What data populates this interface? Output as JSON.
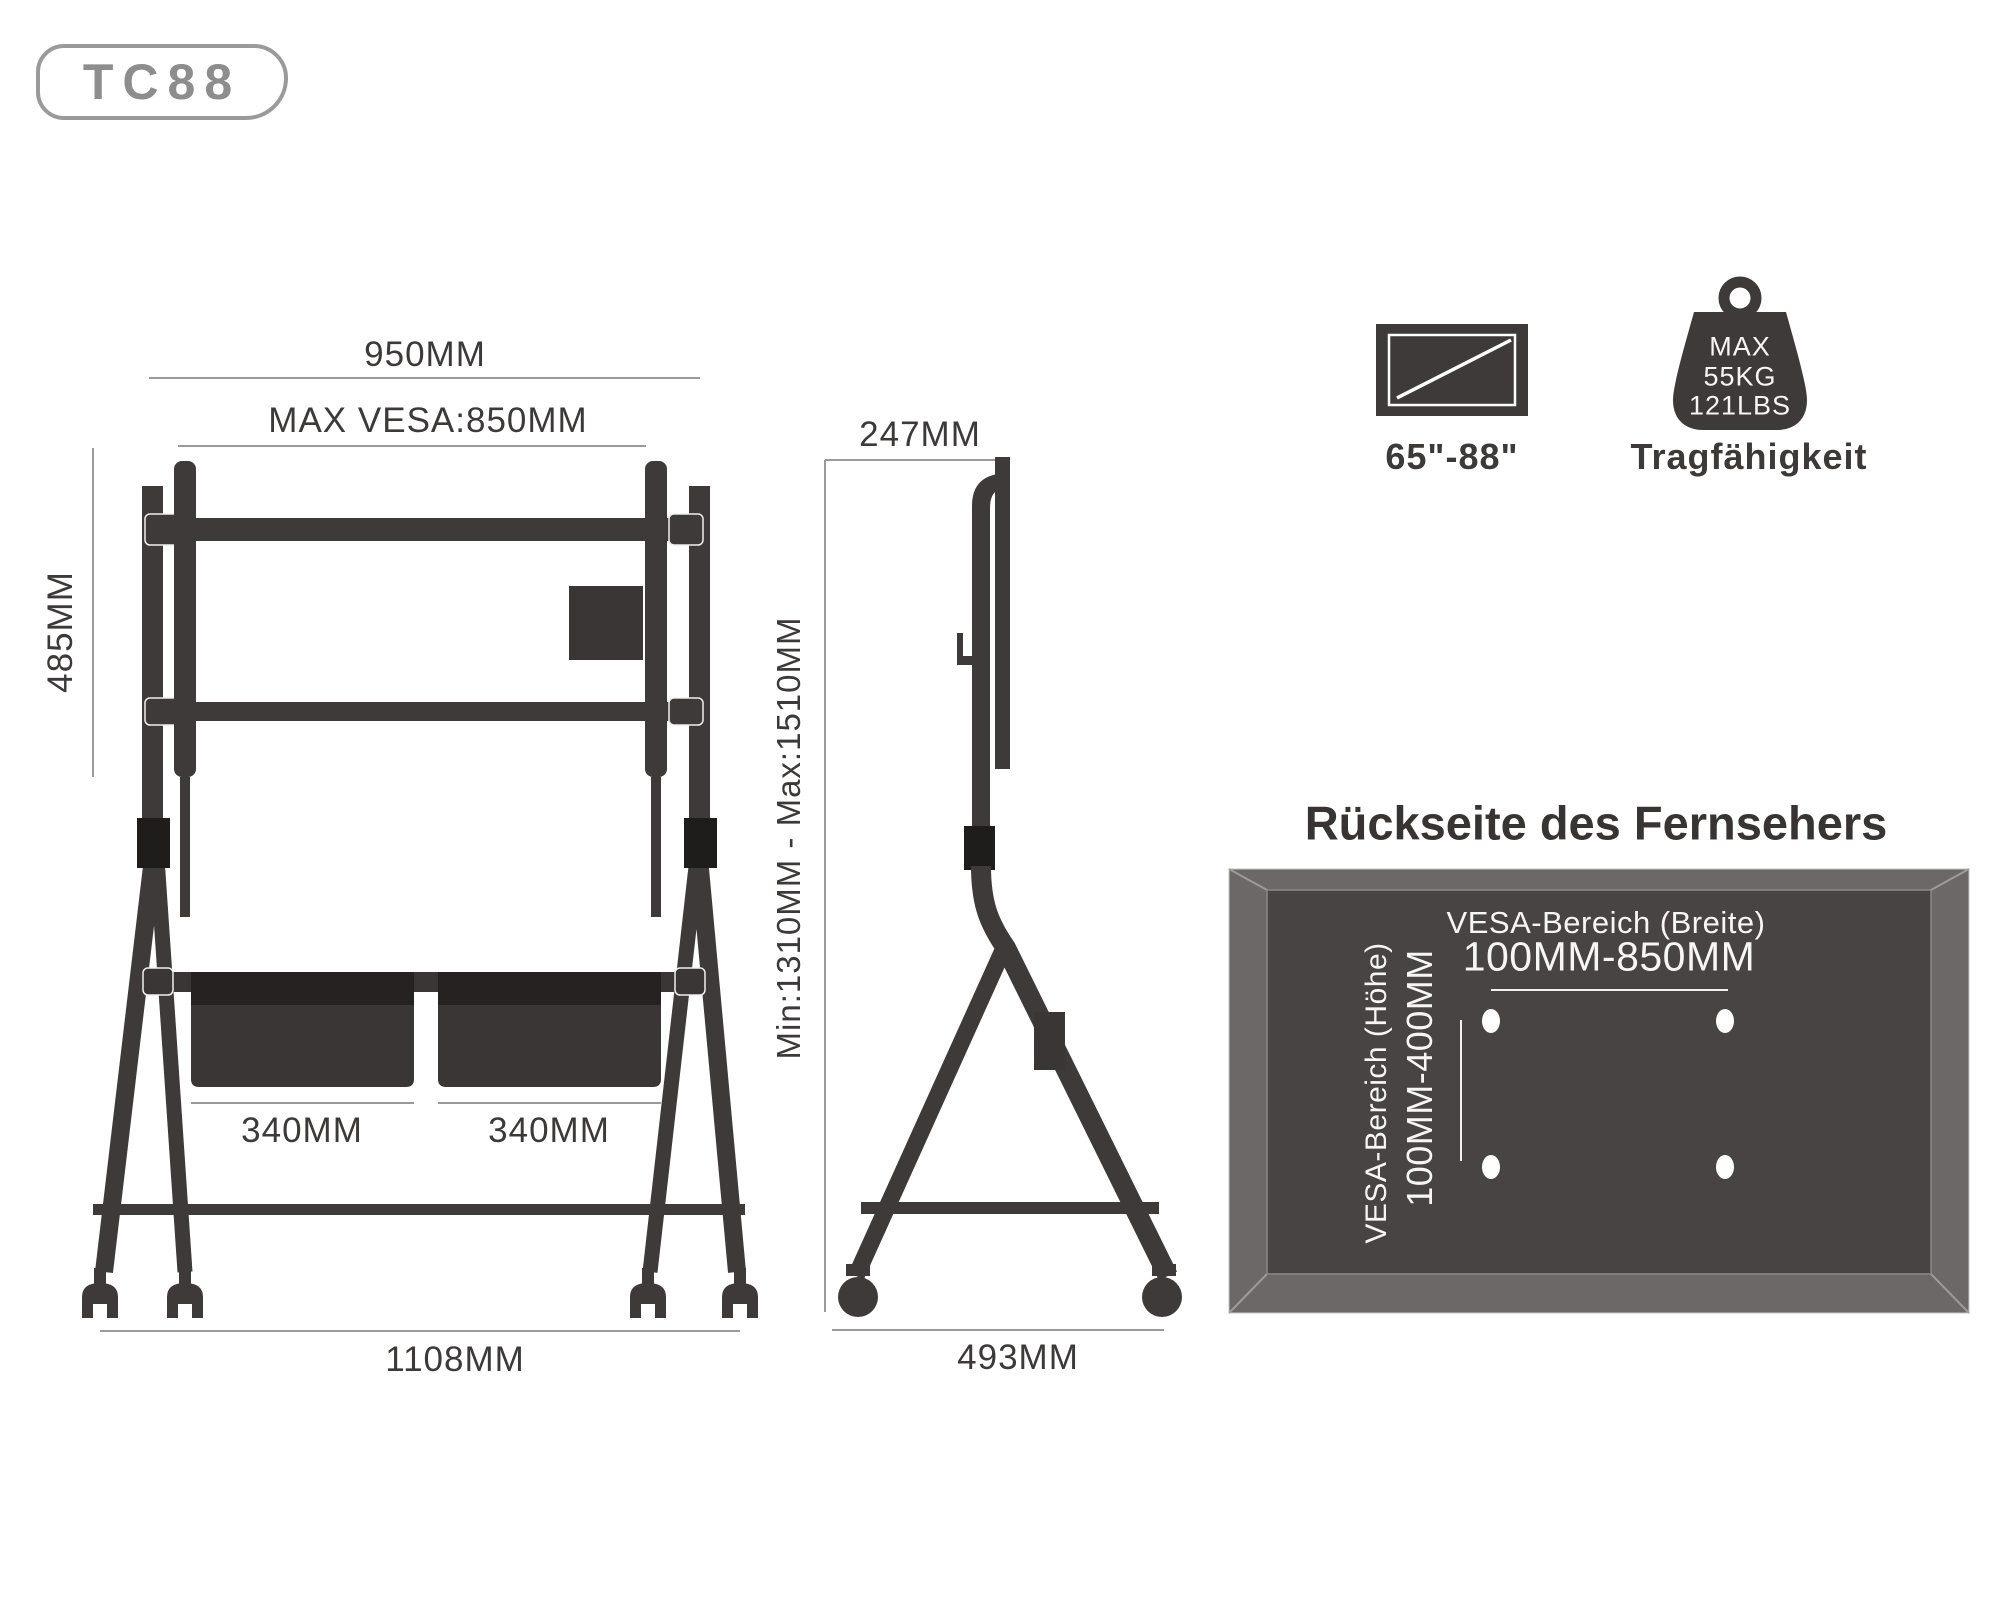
{
  "model_badge": {
    "label": "TC88"
  },
  "front_view": {
    "dim_top_width": "950MM",
    "dim_max_vesa": "MAX VESA:850MM",
    "dim_bracket_height": "485MM",
    "dim_basket_left": "340MM",
    "dim_basket_right": "340MM",
    "dim_base_width": "1108MM"
  },
  "side_view": {
    "dim_top_depth": "247MM",
    "dim_height_range": "Min:1310MM - Max:1510MM",
    "dim_base_depth": "493MM"
  },
  "compat_icons": {
    "screen_size_range": "65\"-88\"",
    "weight_line1": "MAX",
    "weight_line2": "55KG",
    "weight_line3": "121LBS",
    "weight_label": "Tragfähigkeit"
  },
  "back_panel": {
    "title": "Rückseite des Fernsehers",
    "vesa_width_label": "VESA-Bereich (Breite)",
    "vesa_width_value": "100MM-850MM",
    "vesa_height_label": "VESA-Bereich (Höhe)",
    "vesa_height_value": "100MM-400MM"
  },
  "colors": {
    "structure_ink": "#3e3a39",
    "clamp_black": "#1f1c1c",
    "dimension_line": "#9a9a9a",
    "dimension_text": "#3c3939",
    "panel_frame": "#6b6867",
    "panel_inner": "#474443",
    "panel_text": "#f7f6f5",
    "background": "#ffffff"
  }
}
